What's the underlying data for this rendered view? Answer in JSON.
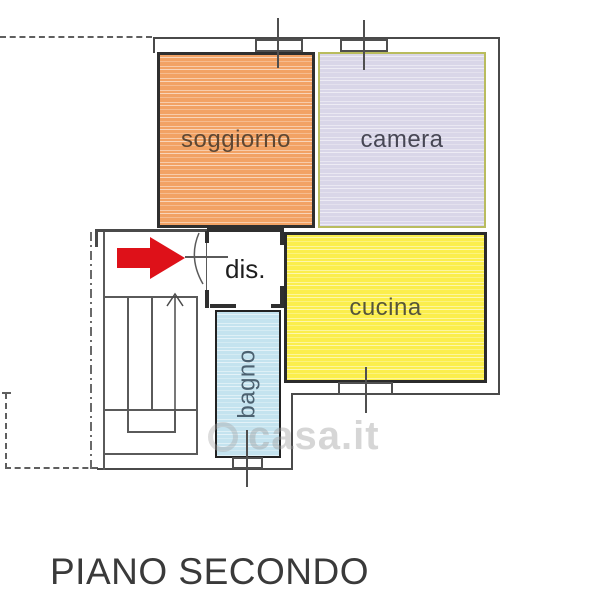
{
  "page": {
    "title": "PIANO SECONDO"
  },
  "watermark": {
    "text": "casa.it",
    "icon": "house-in-circle-icon"
  },
  "rooms": {
    "soggiorno": {
      "label": "soggiorno",
      "fill": "#f2a264",
      "border": "#2f2f2f",
      "text_color": "#5e4733"
    },
    "camera": {
      "label": "camera",
      "fill": "#d9d6e8",
      "border": "#b9bc5e",
      "text_color": "#474754"
    },
    "cucina": {
      "label": "cucina",
      "fill": "#fbee4c",
      "border": "#2b2b2b",
      "text_color": "#55553a"
    },
    "bagno": {
      "label": "bagno",
      "fill": "#c4e3ef",
      "border": "#222222",
      "text_color": "#4c6170"
    },
    "disimpegno": {
      "label": "dis.",
      "fill": "#ffffff",
      "text_color": "#1e1e1e"
    }
  },
  "symbols": {
    "entrance_arrow": {
      "icon": "entrance-arrow-icon",
      "color": "#de1119"
    },
    "stairs_arrow": {
      "icon": "stairs-up-arrow-icon",
      "color": "#4a4a4a"
    }
  },
  "colors": {
    "walls": "#4a4a4a",
    "boundary_dashed": "#5f5f5f"
  }
}
